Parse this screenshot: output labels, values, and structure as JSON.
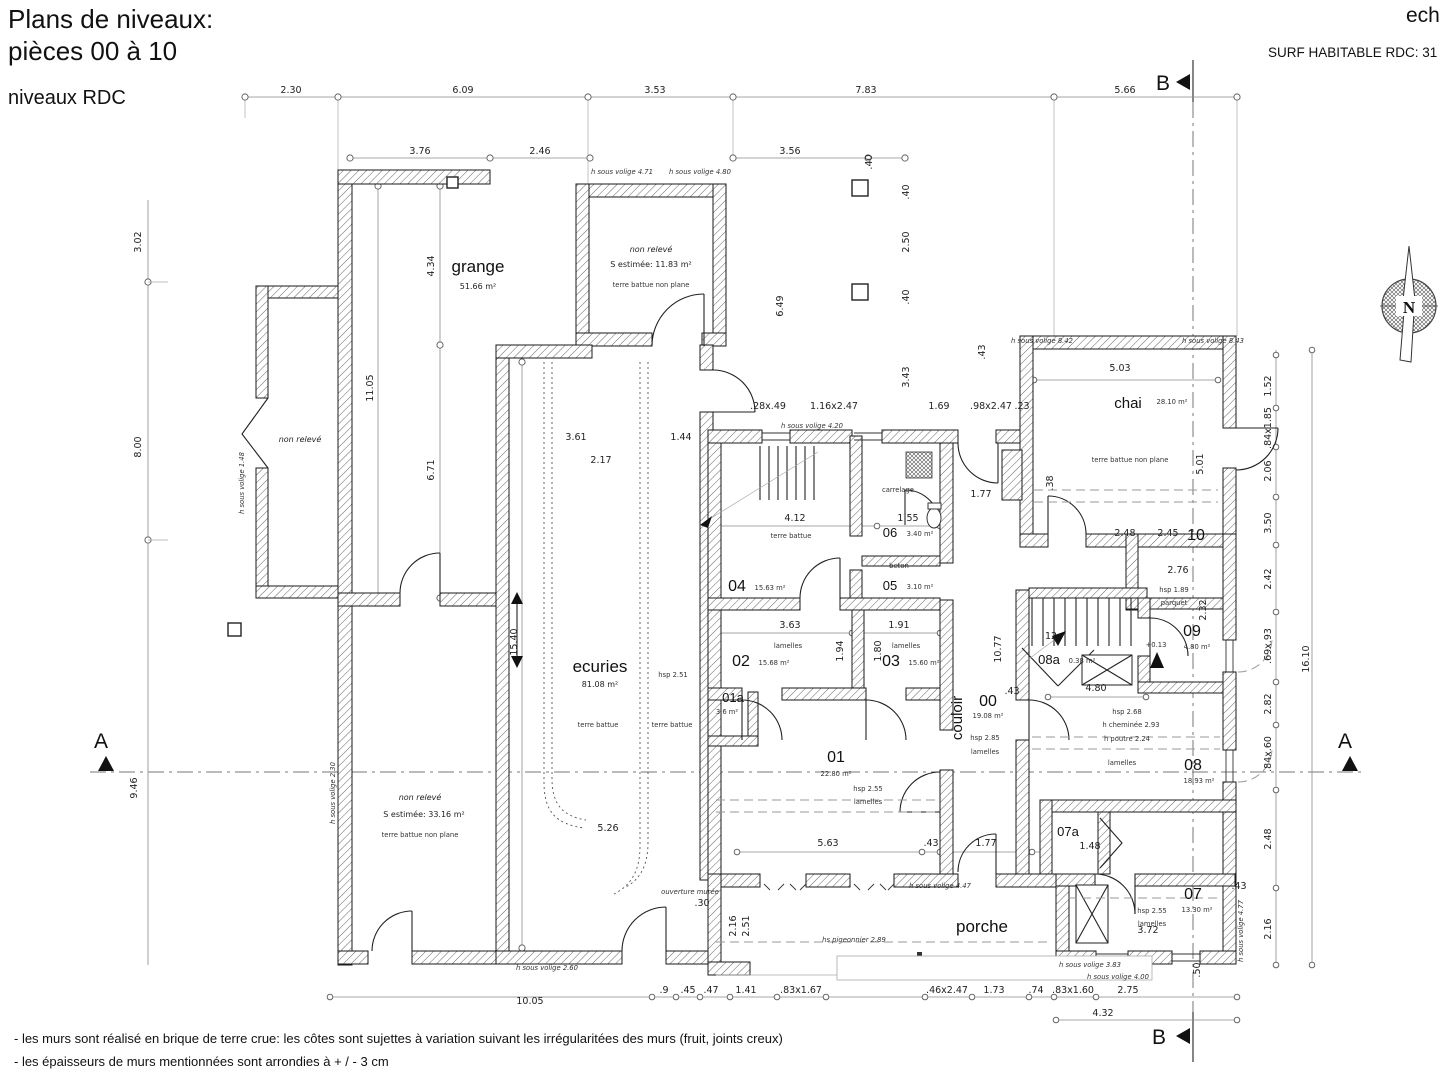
{
  "header": {
    "title_line1": "Plans de niveaux:",
    "title_line2": "pièces 00 à 10",
    "subtitle": "niveaux RDC",
    "scale": "ech",
    "surface": "SURF HABITABLE RDC: 31"
  },
  "sections": {
    "a": "A",
    "b": "B"
  },
  "compass": {
    "north": "N"
  },
  "notes": {
    "line1": "- les murs sont réalisé en brique de terre crue: les côtes sont sujettes à variation suivant les irrégularitées des murs (fruit, joints creux)",
    "line2": "- les épaisseurs de murs mentionnées sont arrondies à + / - 3 cm"
  },
  "rooms": {
    "grange": {
      "name": "grange",
      "area": "51.66 m²"
    },
    "annexe": {
      "name": "non relevé"
    },
    "remise": {
      "name": "non relevé",
      "area": "S estimée: 11.83 m²",
      "floor": "terre battue non plane"
    },
    "ecuries": {
      "name": "ecuries",
      "area": "81.08 m²",
      "floor": "terre battue",
      "hsp": "hsp 2.51",
      "floor2": "terre battue"
    },
    "reserve": {
      "name": "non relevé",
      "area": "S estimée: 33.16 m²",
      "floor": "terre battue non plane"
    },
    "chai": {
      "name": "chai",
      "area": "28.10 m²",
      "floor": "terre battue non plane"
    },
    "couloir": {
      "name": "couloir"
    },
    "porche": {
      "name": "porche"
    },
    "r00": {
      "num": "00",
      "area": "19.08 m²",
      "hsp": "hsp 2.85",
      "ceiling": "lamelles"
    },
    "r01": {
      "num": "01",
      "area": "22.80 m²",
      "hsp": "hsp 2.55",
      "ceiling": "lamelles"
    },
    "r01a": {
      "num": "01a",
      "area": "3.6 m²"
    },
    "r02": {
      "num": "02",
      "area": "15.68 m²",
      "ceiling": "lamelles"
    },
    "r03": {
      "num": "03",
      "area": "15.60 m²",
      "ceiling": "lamelles"
    },
    "r04": {
      "num": "04",
      "area": "15.63 m²",
      "floor": "terre battue"
    },
    "r05": {
      "num": "05",
      "area": "3.10 m²",
      "floor": "beton"
    },
    "r06": {
      "num": "06",
      "area": "3.40 m²",
      "floor": "carrelage"
    },
    "r07": {
      "num": "07",
      "area": "13.30 m²",
      "hsp": "hsp 2.55",
      "ceiling": "lamelles"
    },
    "r07a": {
      "num": "07a"
    },
    "r08": {
      "num": "08",
      "area": "18.93 m²",
      "hsp": "hsp 2.68",
      "note1": "h cheminée 2.93",
      "note2": "h poutre 2.24",
      "ceiling": "lamelles"
    },
    "r08a": {
      "num": "08a",
      "area": "0.38 m²"
    },
    "r09": {
      "num": "09",
      "area": "4.80 m²",
      "level": "+0.13"
    },
    "r10": {
      "num": "10",
      "hsp": "hsp 1.89",
      "floor": "parquet"
    }
  },
  "dims": [
    {
      "t": "2.30",
      "x": 291,
      "y": 93
    },
    {
      "t": "6.09",
      "x": 463,
      "y": 93
    },
    {
      "t": "3.53",
      "x": 655,
      "y": 93
    },
    {
      "t": "7.83",
      "x": 866,
      "y": 93
    },
    {
      "t": "5.66",
      "x": 1125,
      "y": 93
    },
    {
      "t": "3.76",
      "x": 420,
      "y": 154
    },
    {
      "t": "2.46",
      "x": 540,
      "y": 154
    },
    {
      "t": "3.56",
      "x": 790,
      "y": 154
    },
    {
      "t": ".40",
      "x": 872,
      "y": 162,
      "r": -90
    },
    {
      "t": "3.02",
      "x": 141,
      "y": 242,
      "r": -90
    },
    {
      "t": "8.00",
      "x": 141,
      "y": 447,
      "r": -90
    },
    {
      "t": "9.46",
      "x": 137,
      "y": 788,
      "r": -90
    },
    {
      "t": "11.05",
      "x": 373,
      "y": 388,
      "r": -90
    },
    {
      "t": "4.34",
      "x": 434,
      "y": 266,
      "r": -90
    },
    {
      "t": "6.71",
      "x": 434,
      "y": 470,
      "r": -90
    },
    {
      "t": "15.40",
      "x": 517,
      "y": 642,
      "r": -90
    },
    {
      "t": "3.61",
      "x": 576,
      "y": 440
    },
    {
      "t": "2.17",
      "x": 601,
      "y": 463
    },
    {
      "t": "1.44",
      "x": 681,
      "y": 440
    },
    {
      "t": "6.49",
      "x": 783,
      "y": 306,
      "r": -90
    },
    {
      "t": ".40",
      "x": 909,
      "y": 192,
      "r": -90
    },
    {
      "t": "2.50",
      "x": 909,
      "y": 242,
      "r": -90
    },
    {
      "t": ".40",
      "x": 909,
      "y": 297,
      "r": -90
    },
    {
      "t": "3.43",
      "x": 909,
      "y": 377,
      "r": -90
    },
    {
      "t": ".28x.49",
      "x": 768,
      "y": 409
    },
    {
      "t": "1.16x2.47",
      "x": 834,
      "y": 409
    },
    {
      "t": "1.69",
      "x": 939,
      "y": 409
    },
    {
      "t": ".98x2.47",
      "x": 991,
      "y": 409
    },
    {
      "t": ".23",
      "x": 1022,
      "y": 409
    },
    {
      "t": "4.12",
      "x": 795,
      "y": 521
    },
    {
      "t": "1.55",
      "x": 908,
      "y": 521
    },
    {
      "t": "1.77",
      "x": 981,
      "y": 497
    },
    {
      "t": "3.63",
      "x": 790,
      "y": 628
    },
    {
      "t": "1.91",
      "x": 899,
      "y": 628
    },
    {
      "t": "1.94",
      "x": 843,
      "y": 651,
      "r": -90
    },
    {
      "t": "1.80",
      "x": 881,
      "y": 651,
      "r": -90
    },
    {
      "t": "5.03",
      "x": 1120,
      "y": 371
    },
    {
      "t": "5.01",
      "x": 1203,
      "y": 464,
      "r": -90
    },
    {
      "t": ".38",
      "x": 1053,
      "y": 483,
      "r": -90
    },
    {
      "t": ".43",
      "x": 985,
      "y": 352,
      "r": -90
    },
    {
      "t": "2.48",
      "x": 1125,
      "y": 536
    },
    {
      "t": "2.45",
      "x": 1168,
      "y": 536
    },
    {
      "t": "2.76",
      "x": 1178,
      "y": 573
    },
    {
      "t": "2.32",
      "x": 1206,
      "y": 610,
      "r": -90
    },
    {
      "t": "4.80",
      "x": 1096,
      "y": 691
    },
    {
      "t": "10.77",
      "x": 1001,
      "y": 649,
      "r": -90
    },
    {
      "t": ".43",
      "x": 1012,
      "y": 694
    },
    {
      "t": "12",
      "x": 1051,
      "y": 639
    },
    {
      "t": "1.48",
      "x": 1090,
      "y": 849
    },
    {
      "t": "5.26",
      "x": 608,
      "y": 831
    },
    {
      "t": "5.63",
      "x": 828,
      "y": 846
    },
    {
      "t": ".43",
      "x": 931,
      "y": 846
    },
    {
      "t": "1.77",
      "x": 986,
      "y": 846
    },
    {
      "t": ".30",
      "x": 702,
      "y": 906
    },
    {
      "t": "2.16",
      "x": 736,
      "y": 926,
      "r": -90
    },
    {
      "t": "2.51",
      "x": 749,
      "y": 926,
      "r": -90
    },
    {
      "t": "3.72",
      "x": 1148,
      "y": 933
    },
    {
      "t": ".43",
      "x": 1239,
      "y": 889
    },
    {
      "t": ".50",
      "x": 1200,
      "y": 970,
      "r": -90
    },
    {
      "t": "10.05",
      "x": 530,
      "y": 1004
    },
    {
      "t": ".9",
      "x": 664,
      "y": 993
    },
    {
      "t": ".45",
      "x": 688,
      "y": 993
    },
    {
      "t": ".47",
      "x": 711,
      "y": 993
    },
    {
      "t": "1.41",
      "x": 746,
      "y": 993
    },
    {
      "t": ".83x1.67",
      "x": 801,
      "y": 993
    },
    {
      "t": ".46x2.47",
      "x": 947,
      "y": 993
    },
    {
      "t": "1.73",
      "x": 994,
      "y": 993
    },
    {
      "t": ".74",
      "x": 1036,
      "y": 993
    },
    {
      "t": ".83x1.60",
      "x": 1073,
      "y": 993
    },
    {
      "t": "2.75",
      "x": 1128,
      "y": 993
    },
    {
      "t": "4.32",
      "x": 1103,
      "y": 1016
    },
    {
      "t": "1.52",
      "x": 1271,
      "y": 386,
      "r": -90
    },
    {
      "t": ".84x1.85",
      "x": 1271,
      "y": 428,
      "r": -90
    },
    {
      "t": "2.06",
      "x": 1271,
      "y": 471,
      "r": -90
    },
    {
      "t": "3.50",
      "x": 1271,
      "y": 523,
      "r": -90
    },
    {
      "t": "2.42",
      "x": 1271,
      "y": 579,
      "r": -90
    },
    {
      "t": ".69x.93",
      "x": 1271,
      "y": 646,
      "r": -90
    },
    {
      "t": "2.82",
      "x": 1271,
      "y": 704,
      "r": -90
    },
    {
      "t": ".84x.60",
      "x": 1271,
      "y": 754,
      "r": -90
    },
    {
      "t": "2.48",
      "x": 1271,
      "y": 839,
      "r": -90
    },
    {
      "t": "2.16",
      "x": 1271,
      "y": 929,
      "r": -90
    },
    {
      "t": "16.10",
      "x": 1309,
      "y": 659,
      "r": -90
    }
  ],
  "volige": [
    {
      "t": "h sous volige 4.71",
      "x": 622,
      "y": 174
    },
    {
      "t": "h sous volige 4.80",
      "x": 700,
      "y": 174
    },
    {
      "t": "h sous volige 4.20",
      "x": 812,
      "y": 428
    },
    {
      "t": "h sous volige 8.42",
      "x": 1042,
      "y": 343
    },
    {
      "t": "h sous volige 8.43",
      "x": 1213,
      "y": 343
    },
    {
      "t": "h sous volige 1.48",
      "x": 244,
      "y": 483,
      "r": -90
    },
    {
      "t": "h sous volige 2.30",
      "x": 335,
      "y": 793,
      "r": -90
    },
    {
      "t": "h sous volige 2.60",
      "x": 547,
      "y": 970
    },
    {
      "t": "h sous volige 4.47",
      "x": 940,
      "y": 888
    },
    {
      "t": "h sous volige 3.83",
      "x": 1090,
      "y": 967
    },
    {
      "t": "h sous volige 4.00",
      "x": 1118,
      "y": 979
    },
    {
      "t": "h sous volige 4.77",
      "x": 1243,
      "y": 931,
      "r": -90
    },
    {
      "t": "hs pigeonnier 2.89",
      "x": 854,
      "y": 942
    },
    {
      "t": "ouverture murée",
      "x": 690,
      "y": 894
    }
  ]
}
